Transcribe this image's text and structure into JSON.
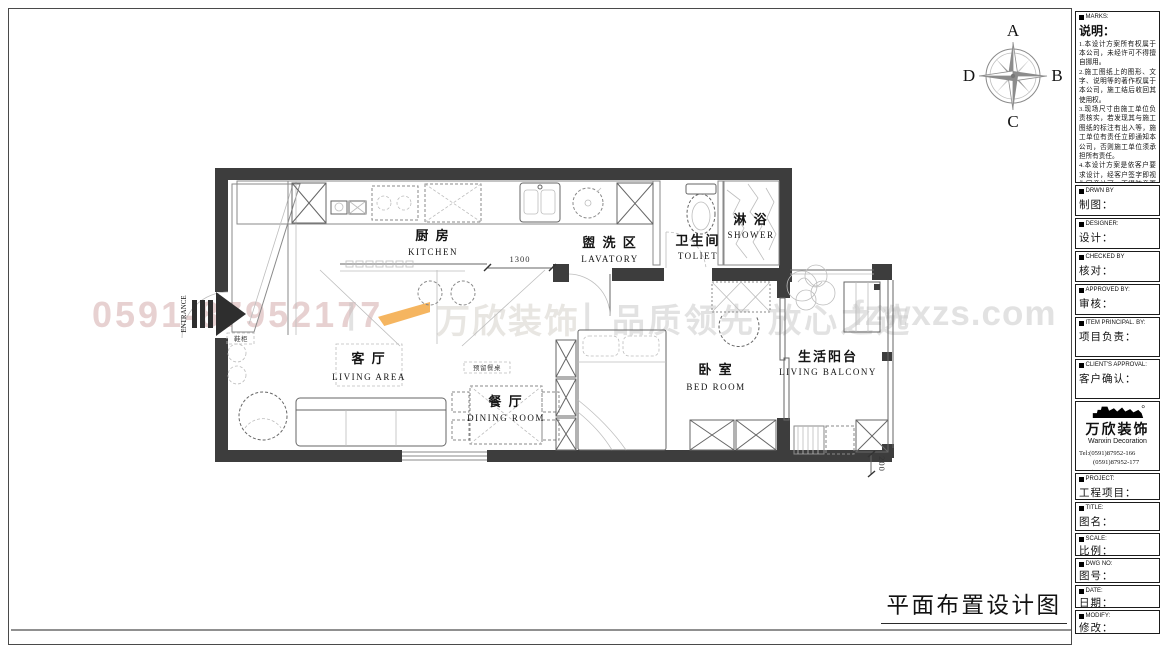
{
  "drawing_title": "平面布置设计图",
  "compass": {
    "n": "A",
    "e": "B",
    "s": "C",
    "w": "D"
  },
  "watermark": {
    "phone": "0591-87952177",
    "separator": "|",
    "brand": "万欣装饰",
    "slogan": "品质领先 放心之选",
    "url": "fzwxzs.com"
  },
  "plan": {
    "rooms": {
      "kitchen": {
        "cn": "厨 房",
        "en": "KITCHEN"
      },
      "lavatory": {
        "cn": "盥 洗 区",
        "en": "LAVATORY"
      },
      "toilet": {
        "cn": "卫生间",
        "en": "TOLIET"
      },
      "shower": {
        "cn": "淋 浴",
        "en": "SHOWER"
      },
      "living": {
        "cn": "客 厅",
        "en": "LIVING  AREA"
      },
      "dining": {
        "cn": "餐 厅",
        "en": "DINING ROOM"
      },
      "bedroom": {
        "cn": "卧 室",
        "en": "BED  ROOM"
      },
      "balcony": {
        "cn": "生活阳台",
        "en": "LIVING BALCONY"
      }
    },
    "entrance_label": "ENTRANCE",
    "dim_kitchen": "1300",
    "dim_balcony": "200",
    "note_dining": "预留餐桌",
    "note_entry": "鞋柜"
  },
  "titleblock": {
    "notes": {
      "header": "MARKS:",
      "title": "说明：",
      "items": [
        "1.本设计方案所有权属于本公司，未经许可不得擅自挪用。",
        "2.施工图纸上的图形、文字、说明等的著作权属于本公司，施工结后收回其使用权。",
        "3.现场尺寸由施工单位负责核实，若发现其与施工图纸的标注有出入等，施工单位有责任立即通知本公司，否则施工单位须承担所有责任。",
        "4.本设计方案是依客户要求设计，经客户签字即视为同意认可，不得随意更改。"
      ]
    },
    "fields": [
      {
        "header": "DRWN BY",
        "label": "制图："
      },
      {
        "header": "DESIGNER:",
        "label": "设计："
      },
      {
        "header": "CHECKED BY",
        "label": "核对："
      },
      {
        "header": "APPROVED BY:",
        "label": "审核："
      },
      {
        "header": "ITEM PRINCIPAL. BY:",
        "label": "项目负责："
      },
      {
        "header": "CLIENT'S APPROVAL:",
        "label": "客户确认："
      }
    ],
    "company": {
      "name": "万欣装饰",
      "name_en": "Wanxin Decoration",
      "tel1": "Tel:(0591)87952-166",
      "tel2": "(0591)87952-177",
      "fax": "Fax:(0591)87952-199",
      "web": "Web:WWW.fzwxzs.com"
    },
    "fields2": [
      {
        "header": "PROJECT:",
        "label": "工程项目："
      },
      {
        "header": "TITLE:",
        "label": "图名："
      },
      {
        "header": "SCALE:",
        "label": "比例："
      },
      {
        "header": "DWG NO:",
        "label": "图号："
      },
      {
        "header": "DATE:",
        "label": "日期："
      },
      {
        "header": "MODIFY:",
        "label": "修改："
      }
    ]
  }
}
